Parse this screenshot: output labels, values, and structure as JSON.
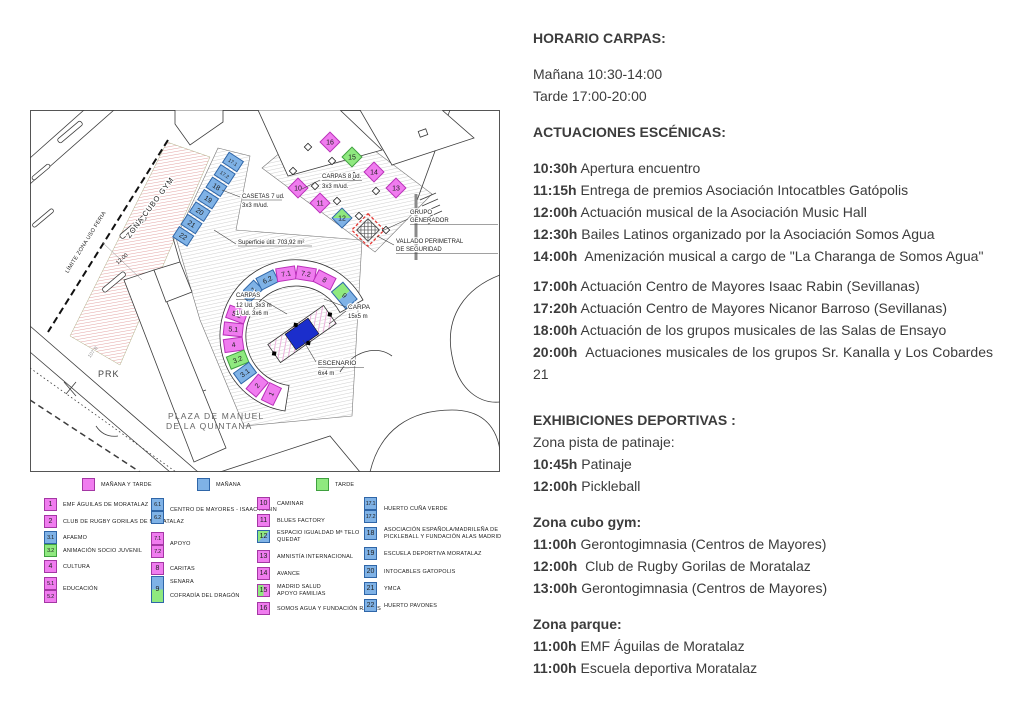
{
  "right_panel": {
    "horario": {
      "title": "HORARIO CARPAS:",
      "manana": "Mañana 10:30-14:00",
      "tarde": "Tarde 17:00-20:00"
    },
    "escenicas": {
      "title": "ACTUACIONES ESCÉNICAS:",
      "morning": [
        {
          "time": "10:30h",
          "desc": "Apertura encuentro"
        },
        {
          "time": "11:15h",
          "desc": "Entrega de premios Asociación Intocatbles Gatópolis"
        },
        {
          "time": "12:00h",
          "desc": "Actuación musical de la Asociación Music Hall"
        },
        {
          "time": "12:30h",
          "desc": "Bailes Latinos organizado por la Asociación Somos Agua"
        },
        {
          "time": "14:00h",
          "desc": "Amenización musical a cargo de \"La Charanga de Somos Agua\""
        }
      ],
      "evening": [
        {
          "time": "17:00h",
          "desc": "Actuación Centro de Mayores Isaac Rabin (Sevillanas)"
        },
        {
          "time": "17:20h",
          "desc": "Actuación Centro de Mayores Nicanor Barroso (Sevillanas)"
        },
        {
          "time": "18:00h",
          "desc": "Actuación de los grupos musicales de las Salas de Ensayo"
        },
        {
          "time": "20:00h",
          "desc": "Actuaciones musicales de los grupos Sr. Kanalla y Los Cobardes 21"
        }
      ]
    },
    "deportivas": {
      "title": "EXHIBICIONES DEPORTIVAS :",
      "subtitle": "Zona pista de patinaje:",
      "items": [
        {
          "time": "10:45h",
          "desc": "Patinaje"
        },
        {
          "time": "12:00h",
          "desc": "Pickleball"
        }
      ]
    },
    "cubo": {
      "title": "Zona cubo gym:",
      "items": [
        {
          "time": "11:00h",
          "desc": "Gerontogimnasia (Centros de Mayores)"
        },
        {
          "time": "12:00h",
          "desc": "Club de Rugby Gorilas de Moratalaz"
        },
        {
          "time": "13:00h",
          "desc": "Gerontogimnasia (Centros de Mayores)"
        }
      ]
    },
    "parque": {
      "title": "Zona parque:",
      "items": [
        {
          "time": "11:00h",
          "desc": "EMF Águilas de Moratalaz"
        },
        {
          "time": "11:00h",
          "desc": "Escuela deportiva Moratalaz"
        }
      ]
    }
  },
  "map": {
    "zona_cubo_gym": "ZONA CUBO GYM",
    "limite": "LÍMITE ZONA USO FERIA",
    "dim": "12.00",
    "prk": "PRK",
    "ref_107b": "107 B",
    "plaza_line1": "PLAZA DE MANUEL",
    "plaza_line2": "DE LA QUINTANA",
    "casetas_label1": "CASETAS 7 ud.",
    "casetas_label2": "3x3 m/ud.",
    "superficie": "Superficie útil: 703,92 m²",
    "carpas8_label1": "CARPAS 8 ud.",
    "carpas8_label2": "3x3 m/ud.",
    "grupo_line1": "GRUPO",
    "grupo_line2": "GENERADOR",
    "vallado_line1": "VALLADO PERIMETRAL",
    "vallado_line2": "DE SEGURIDAD",
    "carpas12_label1": "CARPAS",
    "carpas12_label2": "12 Ud. 3x3 m",
    "carpas12_label3": "1 Ud. 3x6 m",
    "carpa_label1": "CARPA",
    "carpa_label2": "15x5 m",
    "escenario_label1": "ESCENARIO",
    "escenario_label2": "6x4 m",
    "casetas": [
      "17.1",
      "17.2",
      "18",
      "19",
      "20",
      "21",
      "22"
    ],
    "carpas_row1": [
      "16",
      "15",
      "14",
      "13"
    ],
    "carpas_row2": [
      "10",
      "11",
      "12"
    ],
    "arc_top": [
      "6.1",
      "6.2",
      "7.1",
      "7.2",
      "8",
      "9"
    ],
    "arc_left": [
      "5.2",
      "5.1",
      "4",
      "3.2",
      "3.1",
      "2",
      "1"
    ]
  },
  "legend": {
    "key": [
      {
        "label": "MAÑANA Y TARDE",
        "color": "#F07CEF"
      },
      {
        "label": "MAÑANA",
        "color": "#7FB2E6"
      },
      {
        "label": "TARDE",
        "color": "#8FE97F"
      }
    ],
    "col1": [
      {
        "nums": [
          "1"
        ],
        "label": "EMF ÁGUILAS DE MORATALAZ"
      },
      {
        "nums": [
          "2"
        ],
        "label": "CLUB DE RUGBY GORILAS DE MORATALAZ"
      },
      {
        "nums": [
          "3.1"
        ],
        "label": "AFAEMO"
      },
      {
        "nums": [
          "3.2"
        ],
        "label": "ANIMACIÓN SOCIO JUVENIL"
      },
      {
        "nums": [
          "4"
        ],
        "label": "CULTURA"
      },
      {
        "nums": [
          "5.1",
          "5.2"
        ],
        "label": "EDUCACIÓN"
      }
    ],
    "col2": [
      {
        "nums": [
          "6.1",
          "6.2"
        ],
        "label": "CENTRO DE MAYORES - ISAAC RABIN"
      },
      {
        "nums": [
          "7.1",
          "7.2"
        ],
        "label": "APOYO"
      },
      {
        "nums": [
          "8"
        ],
        "label": "CARITAS"
      },
      {
        "nums": [
          "9"
        ],
        "label": "SENARA",
        "label2": "COFRADÍA DEL DRAGÓN"
      }
    ],
    "col3": [
      {
        "nums": [
          "10"
        ],
        "label": "CAMINAR"
      },
      {
        "nums": [
          "11"
        ],
        "label": "BLUES FACTORY"
      },
      {
        "nums": [
          "12"
        ],
        "label": "ESPACIO IGUALDAD Mª TELO",
        "label2": "QUEDAT"
      },
      {
        "nums": [
          "13"
        ],
        "label": "AMNISTÍA INTERNACIONAL"
      },
      {
        "nums": [
          "14"
        ],
        "label": "AVANCE"
      },
      {
        "nums": [
          "15"
        ],
        "label": "MADRID SALUD",
        "label2": "APOYO FAMILIAS"
      },
      {
        "nums": [
          "16"
        ],
        "label": "SOMOS AGUA Y FUNDACIÓN RAÍCES"
      }
    ],
    "col4": [
      {
        "nums": [
          "17.1",
          "17.2"
        ],
        "label": "HUERTO CUÑA VERDE"
      },
      {
        "nums": [
          "18"
        ],
        "label": "ASOCIACIÓN ESPAÑOLA/MADRILEÑA DE",
        "label2": "PICKLEBALL Y FUNDACIÓN ALAS MADRID"
      },
      {
        "nums": [
          "19"
        ],
        "label": "ESCUELA DEPORTIVA MORATALAZ"
      },
      {
        "nums": [
          "20"
        ],
        "label": "INTOCABLES GATOPOLIS"
      },
      {
        "nums": [
          "21"
        ],
        "label": "YMCA"
      },
      {
        "nums": [
          "22"
        ],
        "label": "HUERTO PAVONES"
      }
    ]
  },
  "colors": {
    "manana_y_tarde": "#F07CEF",
    "manana": "#7FB2E6",
    "tarde": "#8FE97F",
    "escenario_azul": "#1B2ECC",
    "vallado_rojo": "#E53935"
  }
}
